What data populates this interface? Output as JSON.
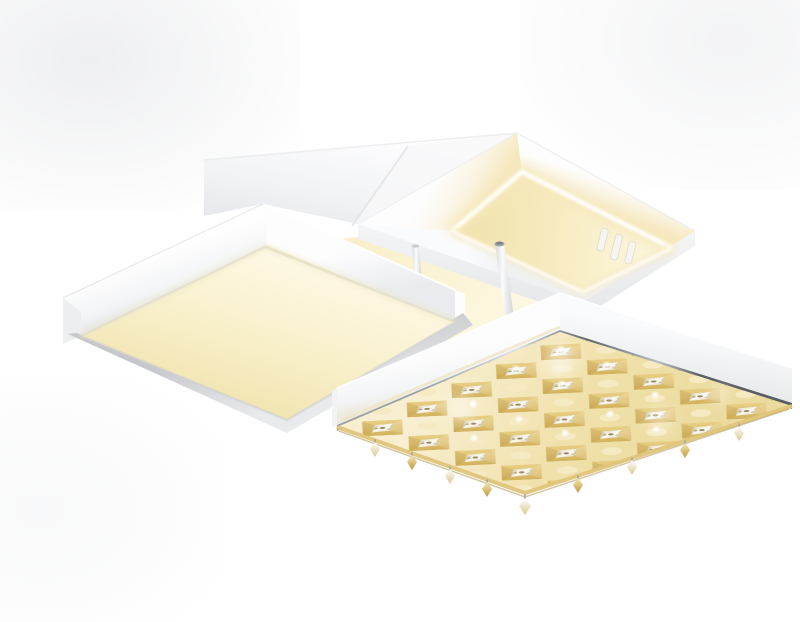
{
  "image": {
    "type": "product-photo",
    "subject": "Modern LED flush-mount ceiling light, viewed from below, three stacked square modules on a white ceiling plate",
    "modules": [
      "large square panel with warm-white glowing diffuser in white frame (left)",
      "open square white frame with inner LED strip ring glowing warm white (top right)",
      "square crystal panel with gold lattice and faceted crystals, chrome trim, lit warm gold (bottom right)"
    ],
    "details": [
      "white mounting backplate recessed behind the LED ring",
      "two thin white suspension rods with chrome caps",
      "three embossed vent marks on the backplate",
      "crystal drops hanging along the lower edges of the crystal panel"
    ]
  },
  "palette": {
    "bg": "#ffffff",
    "vignette": "#d9dbdf",
    "white": "#ffffff",
    "white-soft": "#f6f7f8",
    "white-shade": "#e9ebed",
    "edge-gray": "#d2d4d7",
    "rim-gray": "#c5c7ca",
    "warm-bright": "#fdf8e3",
    "warm-mid": "#f8efc9",
    "warm-deep": "#efe1a8",
    "led-core": "#fffdf4",
    "led-halo": "#f6e8bd",
    "gold-light": "#f2e09d",
    "gold-mid": "#dfc272",
    "gold-deep": "#c19a3f",
    "chrome-dark": "#5f656b",
    "chrome-mid": "#9aa0a5",
    "chrome-light": "#dde1e4",
    "crystal-white": "#ffffff",
    "crystal-shade": "#d6d2c4",
    "accent-dark": "#6e5c38"
  }
}
